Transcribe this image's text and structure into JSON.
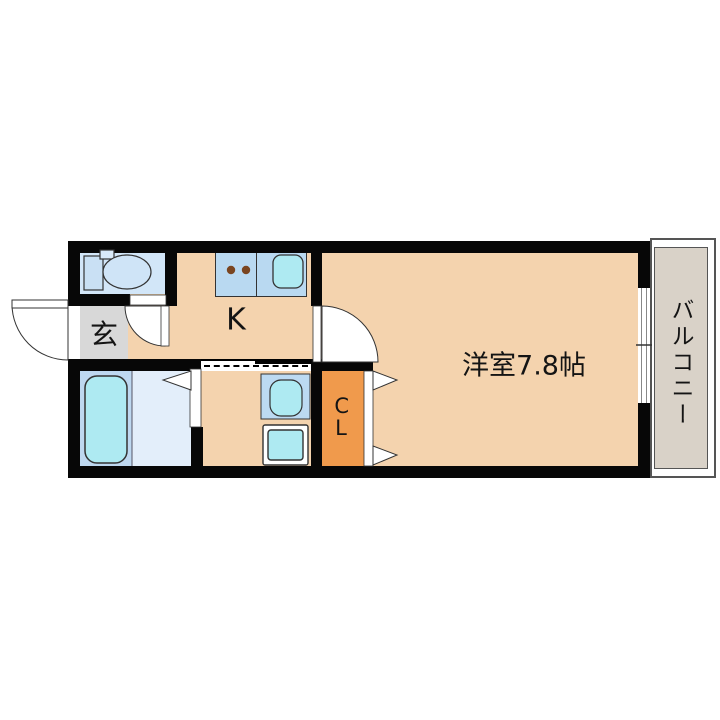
{
  "floor_plan": {
    "main_room": {
      "label": "洋室7.8帖"
    },
    "kitchen": {
      "label": "K"
    },
    "entrance": {
      "label": "玄"
    },
    "closet": {
      "label": "CL"
    },
    "balcony": {
      "label": "バルコニー"
    },
    "colors": {
      "wall": "#070707",
      "room_floor": "#f4d3ae",
      "closet_floor": "#f09a4c",
      "entrance_floor": "#d8d8d8",
      "toilet_room": "#d2e6f8",
      "bath_left_panel": "#bed8f0",
      "bath_right_panel": "#e3eefa",
      "fixture_panel": "#b9d9f1",
      "water_fixture": "#aeeaf2",
      "balcony_floor": "#d9d2c8",
      "burner_dot": "#7a4520"
    }
  }
}
